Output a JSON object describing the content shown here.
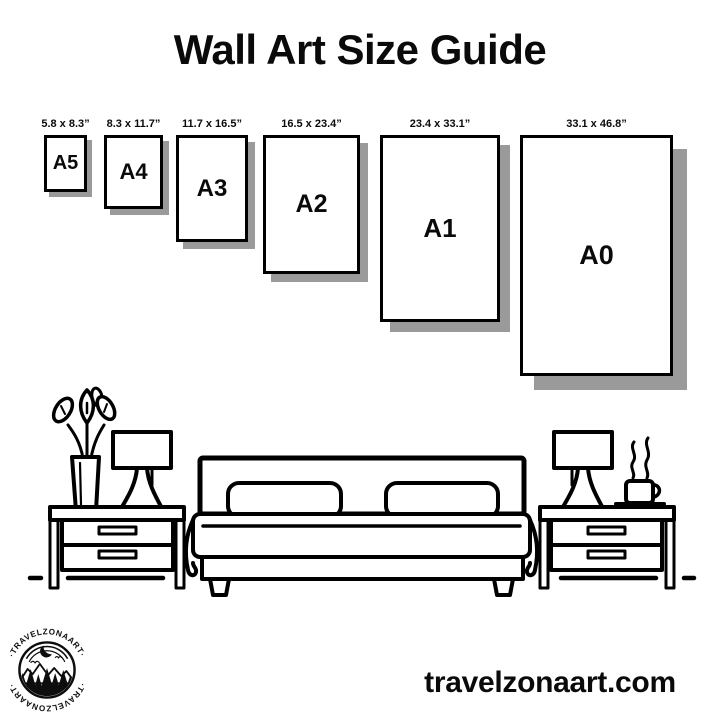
{
  "title": "Wall Art Size Guide",
  "size_guide": {
    "items": [
      {
        "name": "A5",
        "dimensions": "5.8 x 8.3”"
      },
      {
        "name": "A4",
        "dimensions": "8.3 x 11.7”"
      },
      {
        "name": "A3",
        "dimensions": "11.7 x 16.5”"
      },
      {
        "name": "A2",
        "dimensions": "16.5 x 23.4”"
      },
      {
        "name": "A1",
        "dimensions": "23.4 x 33.1”"
      },
      {
        "name": "A0",
        "dimensions": "33.1 x 46.8”"
      }
    ]
  },
  "illustration": {
    "icons": [
      "plant-vase-icon",
      "table-lamp-icon",
      "nightstand-icon",
      "double-bed-icon",
      "pillow-icon",
      "coffee-cup-icon",
      "floor-line"
    ]
  },
  "logo": {
    "brand": "TRAVELZONAART",
    "arc_text_top": "·TRAVELZONAART·",
    "arc_text_bottom": "·TRAVELZONAART·",
    "icons": [
      "crescent-moon-icon",
      "mountains-icon",
      "pine-trees-icon",
      "water-icon",
      "birds-icon"
    ]
  },
  "footer": {
    "website": "travelzonaart.com"
  },
  "colors": {
    "ink": "#000000",
    "shadow": "#9a9a9a",
    "background": "#ffffff"
  }
}
